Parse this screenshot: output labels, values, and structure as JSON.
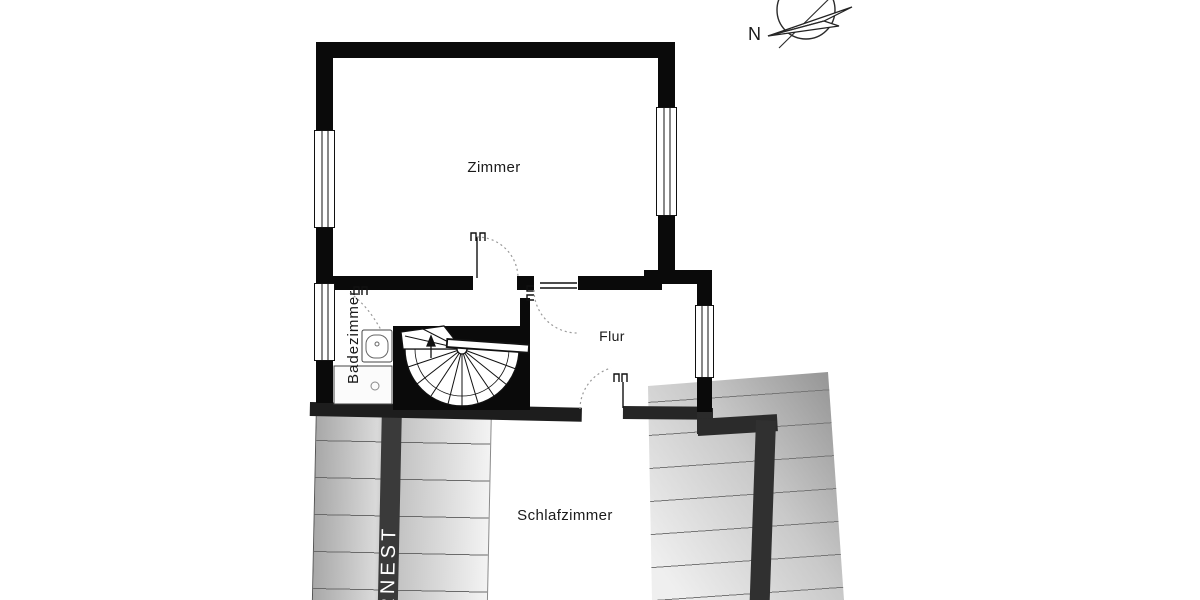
{
  "compass": {
    "label": "N"
  },
  "rooms": {
    "zimmer": {
      "label": "Zimmer"
    },
    "badezimmer": {
      "label": "Badezimmer"
    },
    "flur": {
      "label": "Flur"
    },
    "schlafzimmer": {
      "label": "Schlafzimmer"
    }
  },
  "watermark": {
    "label": "RNEST"
  },
  "colors": {
    "wall": "#0a0a0a",
    "lower_wall": "#2b2b2b",
    "hatch_line": "#6a6a6a",
    "door_arc": "#999999",
    "label_text": "#1a1a1a",
    "watermark_text": "#ffffff",
    "background": "#ffffff"
  }
}
